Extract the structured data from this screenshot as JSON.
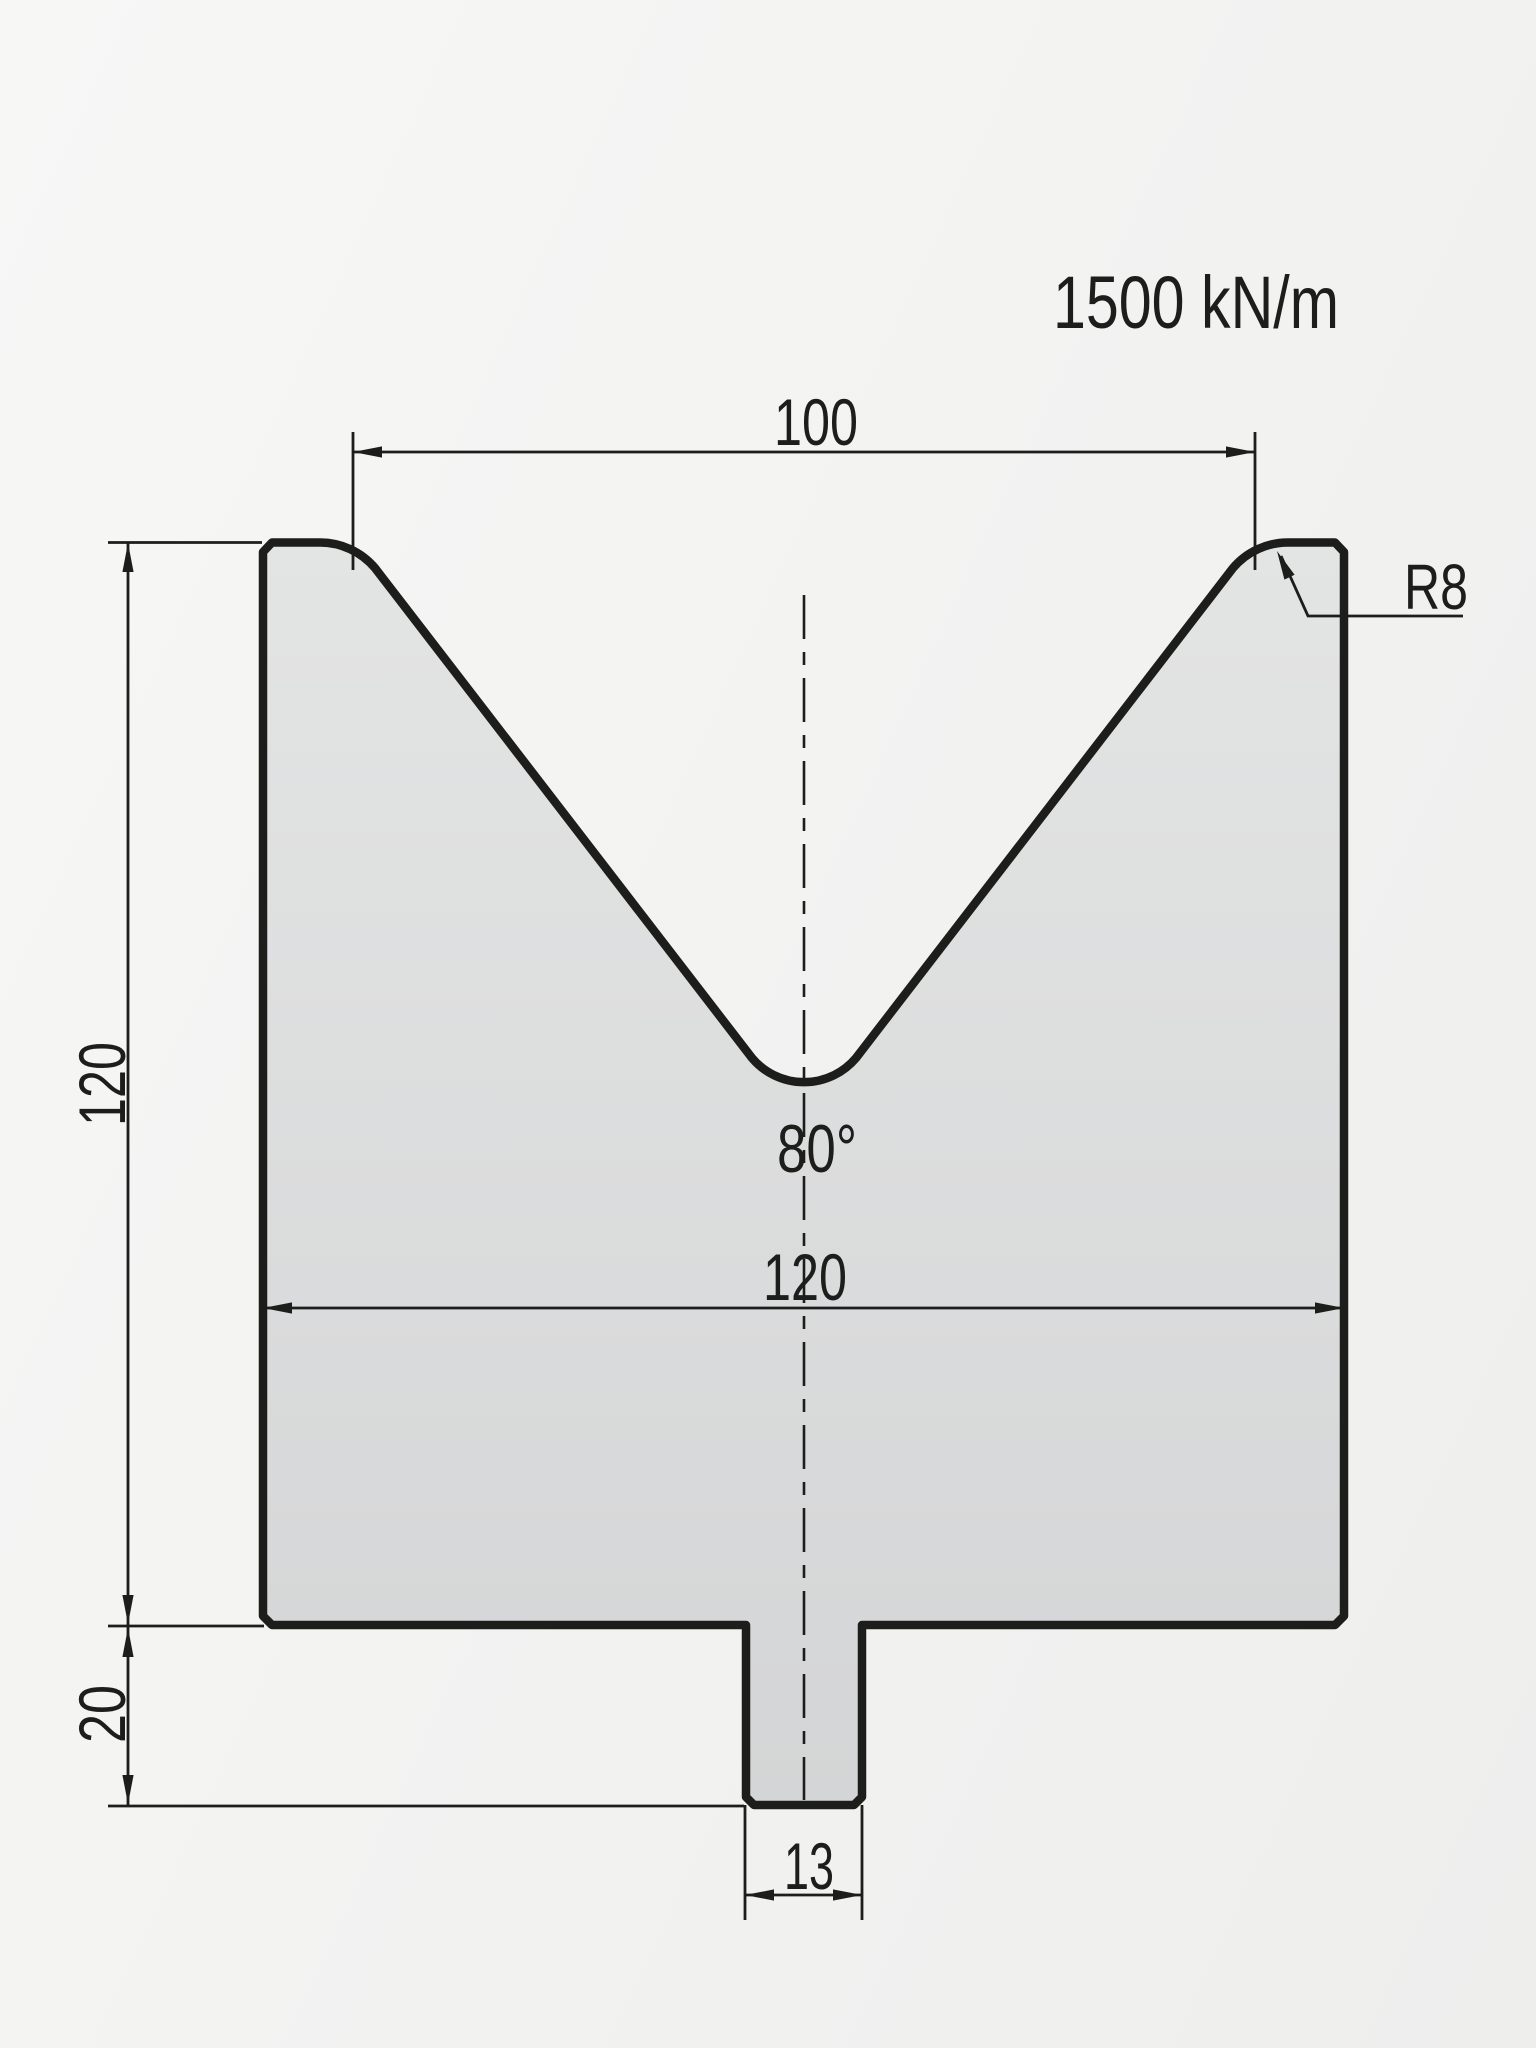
{
  "drawing": {
    "tonnage_label": "1500 kN/m",
    "dimensions": {
      "vee_opening_width": "100",
      "corner_radius": "R8",
      "die_height": "120",
      "vee_angle": "80°",
      "body_width": "120",
      "tang_height": "20",
      "tang_width": "13"
    }
  },
  "colors": {
    "line": "#1d1d1b",
    "part_fill_top": "#e3e4e4",
    "part_fill_bottom": "#d4d5d6",
    "background": "#f2f2f1"
  }
}
